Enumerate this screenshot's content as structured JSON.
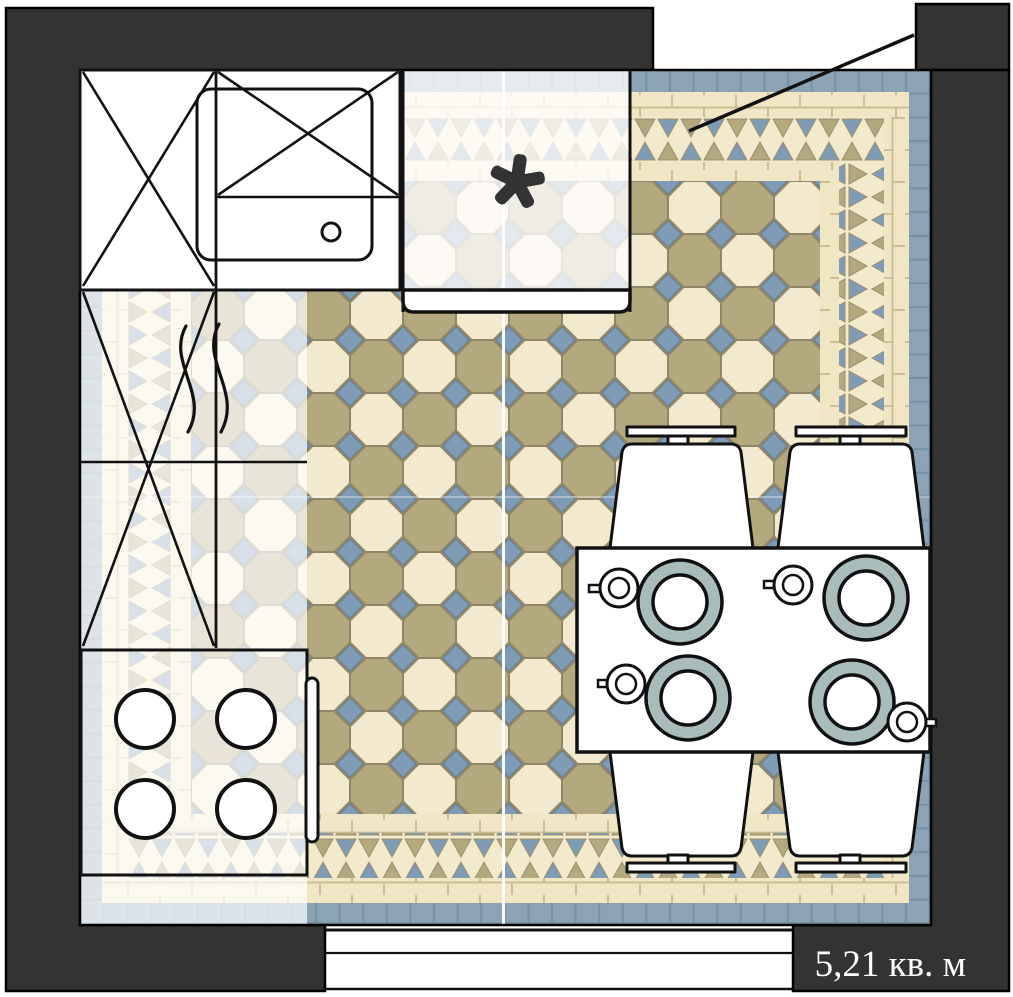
{
  "labels": {
    "area": "5,21 кв. м",
    "window_marker": "✱"
  },
  "colors": {
    "wall": "#333333",
    "line": "#111111",
    "tile_cream": "#f3e9cf",
    "tile_tan": "#b3a87e",
    "tile_blue": "#7e9cb5",
    "border_blue": "#8ba3b4",
    "border_blue_line": "#7292a5",
    "border_cream": "#f1e6c3",
    "border_cream_line": "#c9b98f",
    "zigzag_bg": "#f3e9cb",
    "grout": "#8f8768",
    "plate_rim": "#a9bcbc",
    "white": "#ffffff"
  },
  "furniture": {
    "counter": "counter-with-sink",
    "stove": "stove-4-burners",
    "table": "dining-table",
    "chair_count": 4,
    "plate_count": 4,
    "cup_count": 4
  }
}
